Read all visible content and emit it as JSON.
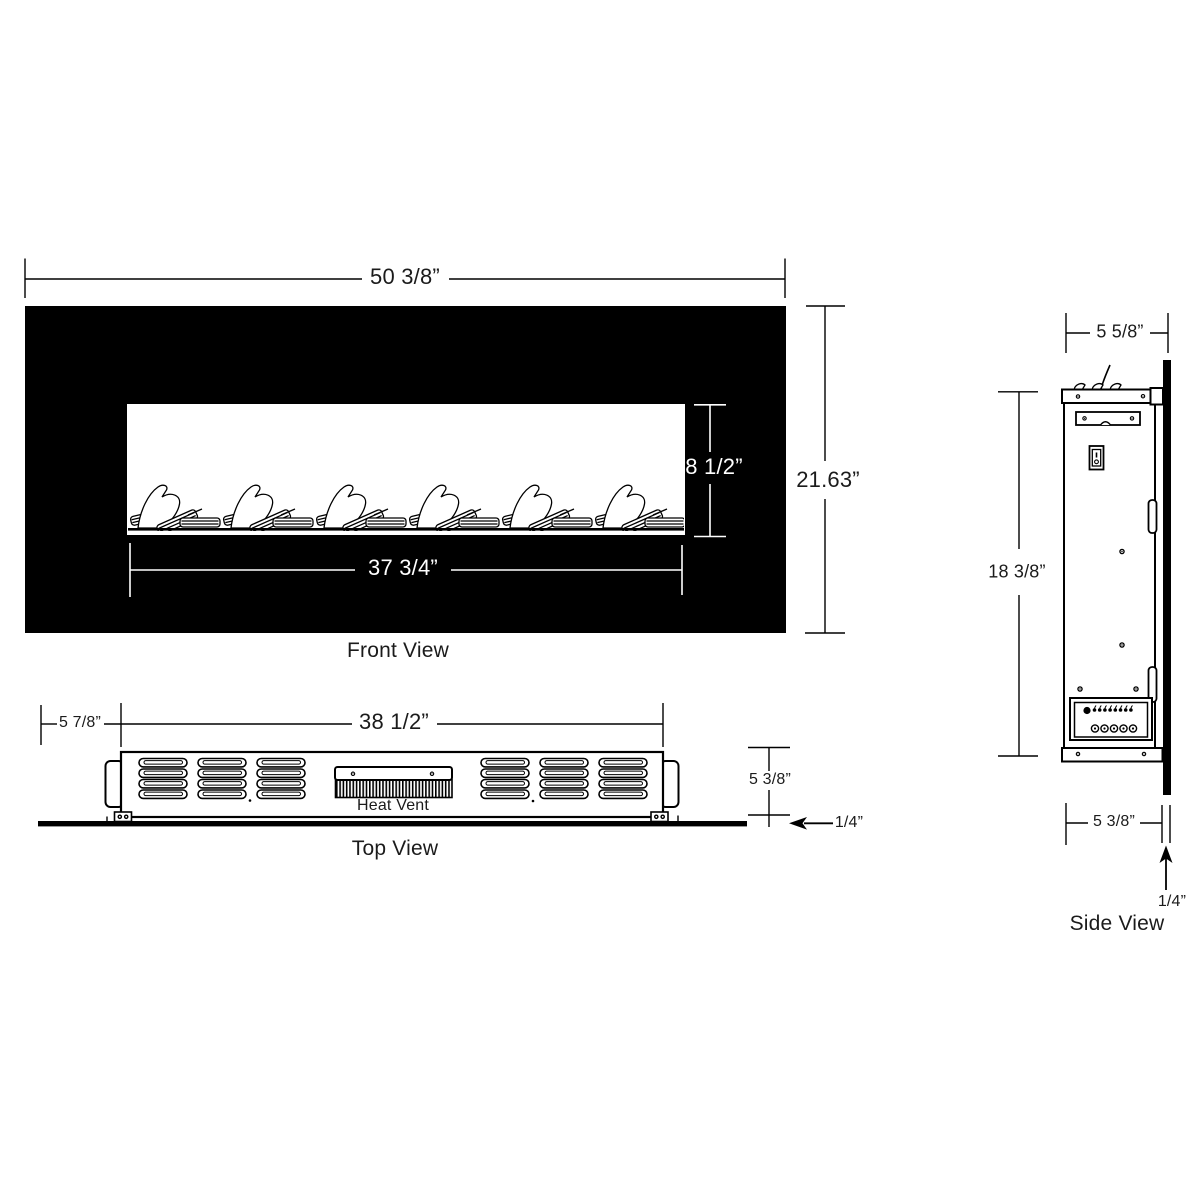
{
  "page": {
    "background": "#ffffff",
    "line_color": "#000000",
    "frame_fill": "#000000"
  },
  "front_view": {
    "caption": "Front View",
    "overall_width": "50 3/8”",
    "overall_height": "21.63”",
    "opening_height": "8 1/2”",
    "opening_width": "37 3/4”"
  },
  "top_view": {
    "caption": "Top View",
    "heat_vent": "Heat Vent",
    "glass_left_offset": "5 7/8”",
    "body_width": "38 1/2”",
    "body_depth": "5 3/8”",
    "glass_thickness": "1/4”"
  },
  "side_view": {
    "caption": "Side View",
    "overall_depth": "5 5/8”",
    "body_height": "18 3/8”",
    "body_depth": "5 3/8”",
    "glass_thickness": "1/4”"
  }
}
